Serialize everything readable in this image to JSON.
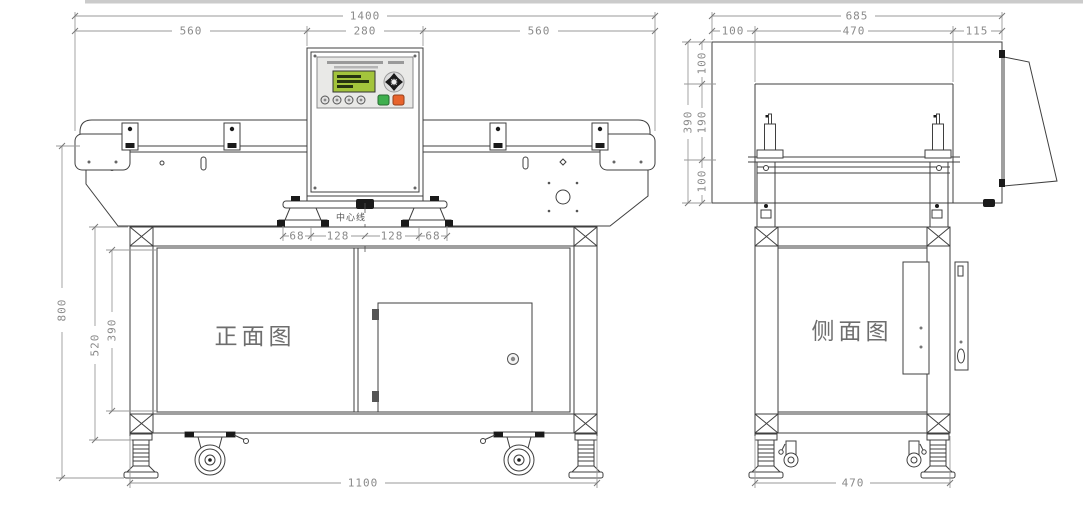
{
  "front_view": {
    "label": "正面图",
    "centerline_label": "中心线",
    "dims": {
      "total_width": "1400",
      "left_section": "560",
      "head_width": "280",
      "right_section": "560",
      "belt_height": "800",
      "stand_height": "520",
      "stand_inner_height": "390",
      "mount_offset_left": "68",
      "mount_span_left": "128",
      "mount_span_right": "128",
      "mount_offset_right": "68",
      "base_width": "1100"
    }
  },
  "side_view": {
    "label": "侧面图",
    "dims": {
      "total_depth": "685",
      "rear_offset": "100",
      "head_depth": "470",
      "front_offset": "115",
      "head_top_offset": "100",
      "body_height": "390",
      "aperture_height": "190",
      "belt_to_base": "100",
      "base_depth": "470"
    }
  },
  "colors": {
    "lcd": "#a3c43c",
    "button_green": "#3faf4e",
    "button_orange": "#e8632c"
  }
}
